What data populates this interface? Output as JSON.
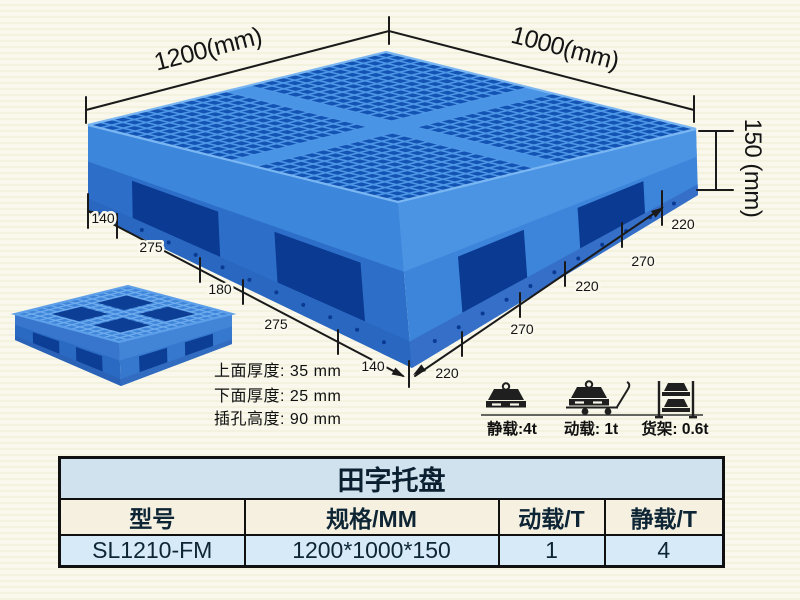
{
  "pallet_diagram": {
    "length_label": "1200(mm)",
    "width_label": "1000(mm)",
    "height_label": "150 (mm)",
    "front_left_segments": [
      "140",
      "275",
      "180",
      "275",
      "140"
    ],
    "front_right_segments": [
      "220",
      "270",
      "220",
      "270",
      "220"
    ],
    "pallet_blue": "#2d6fc8",
    "pallet_dark_blue": "#0a3a92",
    "pallet_rib_blue": "#4e97e6"
  },
  "thickness_notes": {
    "top_thickness": "上面厚度: 35 mm",
    "bottom_thickness": "下面厚度: 25 mm",
    "fork_hole_height": "插孔高度: 90 mm"
  },
  "load_ratings": {
    "static_label": "静载:4t",
    "dynamic_label": "动载: 1t",
    "rack_label": "货架: 0.6t"
  },
  "spec_table": {
    "title": "田字托盘",
    "headers": [
      "型号",
      "规格/MM",
      "动载/T",
      "静载/T"
    ],
    "row": [
      "SL1210-FM",
      "1200*1000*150",
      "1",
      "4"
    ],
    "title_bg": "#cfe2ed",
    "header_bg": "#f5f0e0",
    "row_bg": "#d6eaf7",
    "border_color": "#101010"
  }
}
